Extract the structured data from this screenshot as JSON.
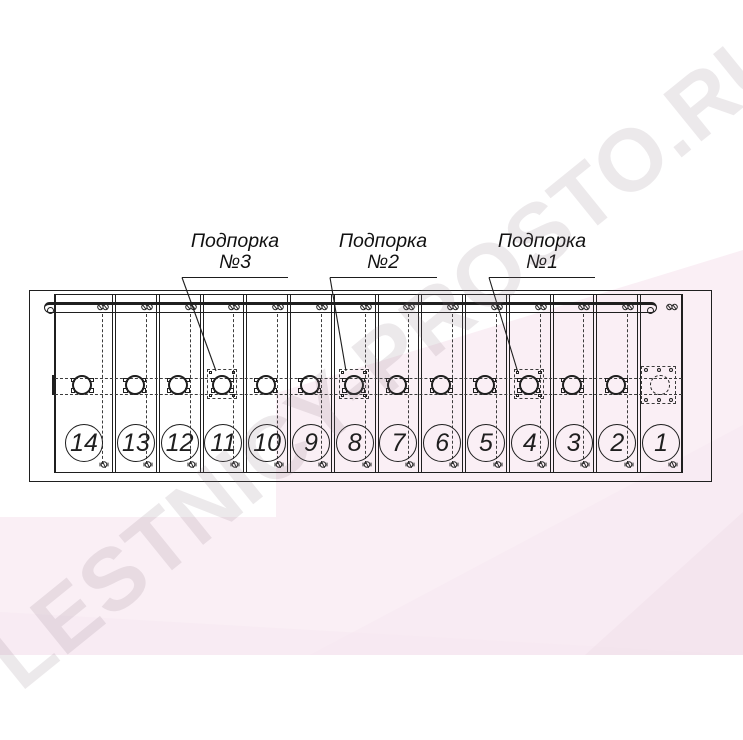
{
  "watermark": {
    "text": "LESTNICY-PROSTO.RU"
  },
  "callouts": [
    {
      "line1": "Подпорка",
      "line2": "№3"
    },
    {
      "line1": "Подпорка",
      "line2": "№2"
    },
    {
      "line1": "Подпорка",
      "line2": "№1"
    }
  ],
  "steps": [
    {
      "number": "14"
    },
    {
      "number": "13"
    },
    {
      "number": "12"
    },
    {
      "number": "11",
      "support": true
    },
    {
      "number": "10"
    },
    {
      "number": "9"
    },
    {
      "number": "8",
      "support": true
    },
    {
      "number": "7"
    },
    {
      "number": "6"
    },
    {
      "number": "5"
    },
    {
      "number": "4",
      "support": true
    },
    {
      "number": "3"
    },
    {
      "number": "2"
    },
    {
      "number": "1",
      "end_plate": true
    }
  ],
  "colors": {
    "line": "#1f1f1f",
    "dash": "#3c3c3c",
    "pink_light": "#faeff5",
    "pink_mid": "#f5e8f0",
    "pink_deep": "#f0e0ea",
    "wm": "rgba(140,127,136,0.17)"
  }
}
